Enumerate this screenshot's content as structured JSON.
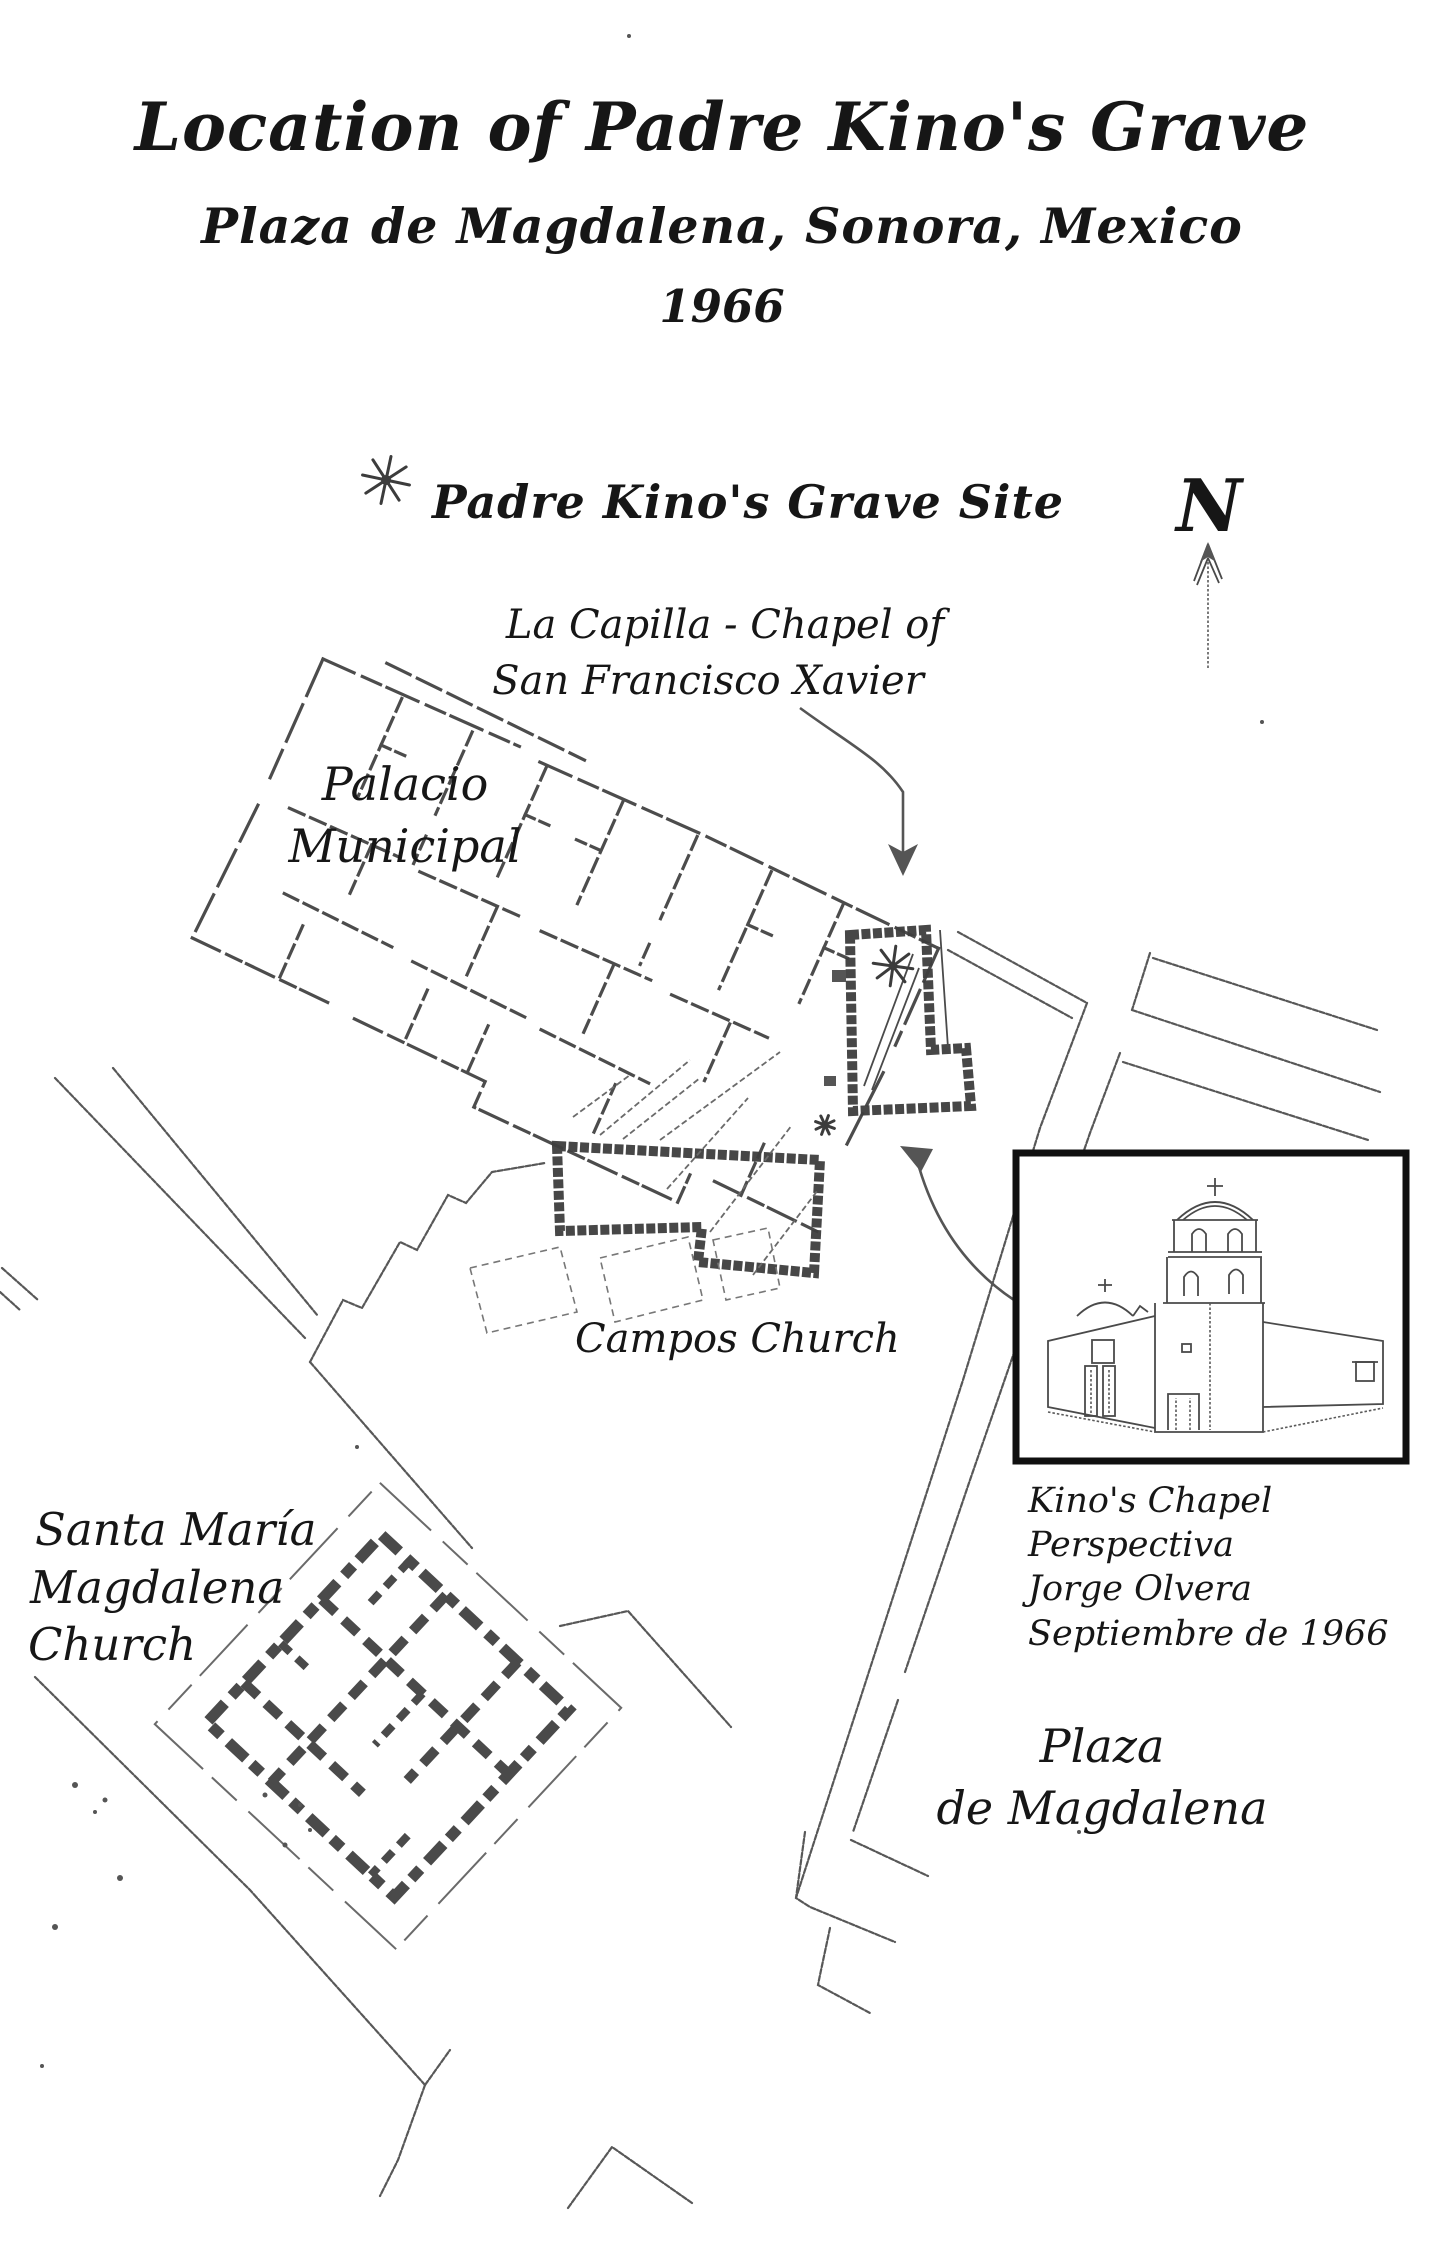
{
  "page": {
    "paper": "#ffffff",
    "ink": "#161616",
    "wall_color": "#3d3d3d",
    "street_color": "#585858"
  },
  "title": {
    "line1": "Location of Padre Kino's Grave",
    "line2": "Plaza de Magdalena, Sonora, Mexico",
    "line3": "1966"
  },
  "legend": {
    "symbol_icon": "eight-point-star",
    "label": "Padre Kino's Grave Site"
  },
  "compass": {
    "label": "N",
    "direction": "up"
  },
  "map_labels": {
    "capilla_line1": "La Capilla - Chapel of",
    "capilla_line2": "San Francisco Xavier",
    "palacio_line1": "Palacio",
    "palacio_line2": "Municipal",
    "campos": "Campos Church",
    "santa_maria_line1": "Santa María",
    "santa_maria_line2": "Magdalena",
    "santa_maria_line3": "Church",
    "plaza_line1": "Plaza",
    "plaza_line2": "de Magdalena"
  },
  "inset": {
    "caption_line1": "Kino's Chapel",
    "caption_line2": "Perspectiva",
    "caption_line3": "Jorge Olvera",
    "caption_line4": "Septiembre de 1966"
  }
}
